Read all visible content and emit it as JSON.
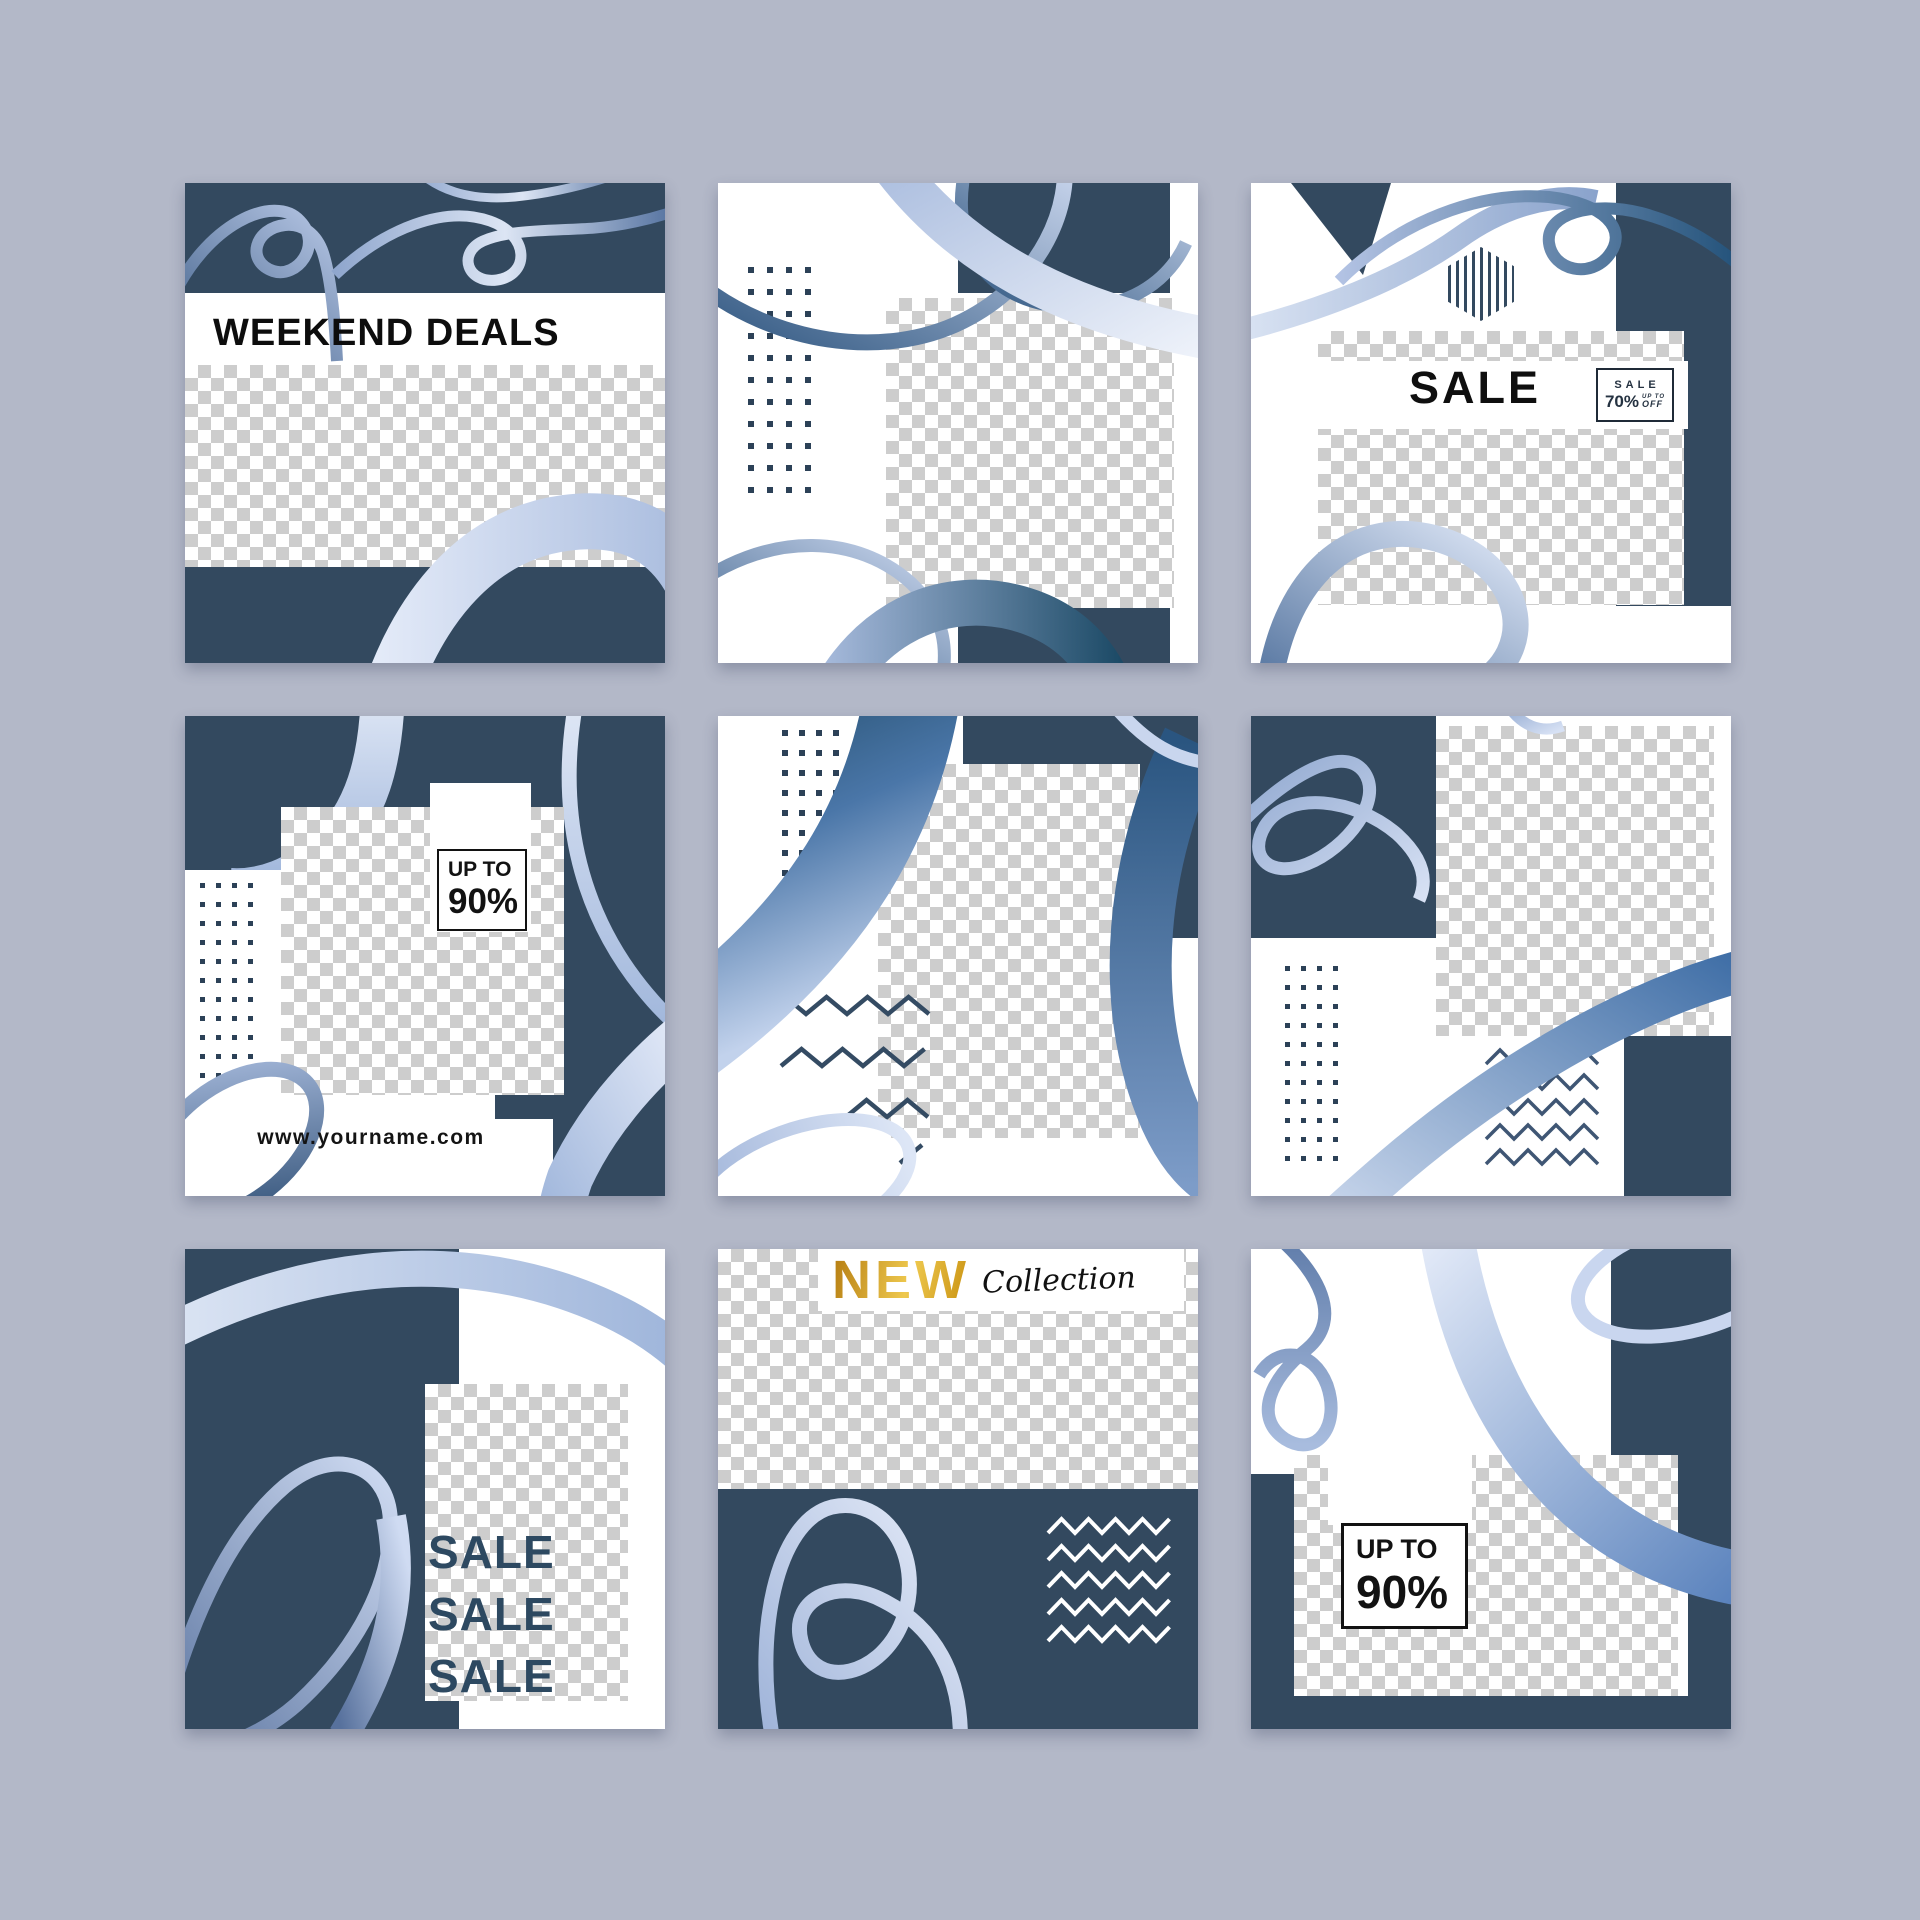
{
  "page": {
    "background_color": "#b3b8c8"
  },
  "palette": {
    "navy": "#33495f",
    "white": "#ffffff",
    "checker_gray": "#cdcdcd",
    "dot_color": "#2c4157",
    "zigzag_navy": "#3a5270",
    "zigzag_white": "#ffffff",
    "gold": "#d29a22",
    "black": "#121212",
    "sale_text_navy": "#2d4961",
    "ribbon_light": "#dce5f4",
    "ribbon_mid": "#8fa6cd",
    "ribbon_dark": "#27506f"
  },
  "cards": [
    {
      "id": "weekend-deals",
      "title": "WEEKEND DEALS"
    },
    {
      "id": "abstract-dots-rings"
    },
    {
      "id": "sale-70",
      "headline": "SALE",
      "badge": {
        "line1": "SALE",
        "percent": "70%",
        "up_to": "UP TO",
        "off": "OFF"
      }
    },
    {
      "id": "up-to-90-left",
      "badge": {
        "up_to": "UP TO",
        "percent": "90%"
      },
      "website": "www.yourname.com"
    },
    {
      "id": "abstract-zigzag-center"
    },
    {
      "id": "abstract-checker-right"
    },
    {
      "id": "sale-stack",
      "lines": [
        "SALE",
        "SALE",
        "SALE"
      ]
    },
    {
      "id": "new-collection",
      "word1": "NEW",
      "word2": "Collection"
    },
    {
      "id": "up-to-90-right",
      "badge": {
        "up_to": "UP TO",
        "percent": "90%"
      }
    }
  ]
}
